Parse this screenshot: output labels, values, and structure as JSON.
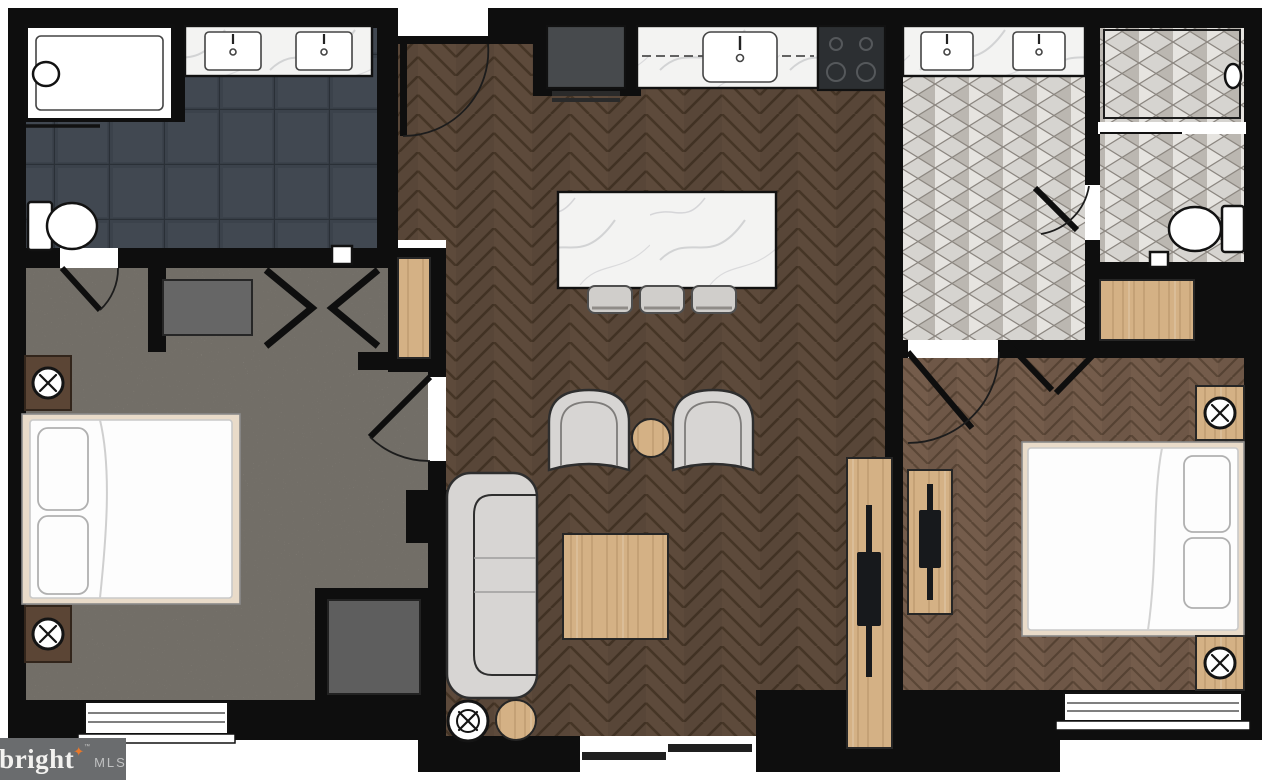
{
  "logo": {
    "brand": "bright",
    "star": "✦",
    "trademark": "™",
    "suffix": "MLS"
  },
  "palette": {
    "wall": "#0e0e0e",
    "white": "#ffffff",
    "slate": "#3b424b",
    "slate_grout": "#2a3037",
    "carpet": "#a9a399",
    "carpet_fleck": "#4a463f",
    "living_floor": "#5d4a3b",
    "living_seam": "#453526",
    "bedroom_floor": "#745c4b",
    "bedroom_seam": "#5a4636",
    "tile_base": "#d6d4d0",
    "tile_light": "#e6e4e0",
    "tile_line": "#8b8680",
    "tile_dark": "#8f8a82",
    "marble": "#f3f3f2",
    "marble_vein": "#c9cacd",
    "wood": "#d4b185",
    "wood_edge": "#8a6b47",
    "appliance": "#474a4d",
    "stove": "#2c2f32",
    "sofa": "#d7d5d3",
    "furn_outline": "#2e2e2e",
    "dresser_gray": "#666666",
    "dresser_dark": "#5e5e5e",
    "nightstand_brown": "#5b4535",
    "tv": "#17191c",
    "bed_frame": "#e9dbc9",
    "bed_white": "#fdfdfd",
    "logo_bg": "#6a6c6e",
    "logo_text": "#f3f2f0",
    "logo_star": "#e8782b",
    "logo_mls": "#c0c1c2"
  }
}
